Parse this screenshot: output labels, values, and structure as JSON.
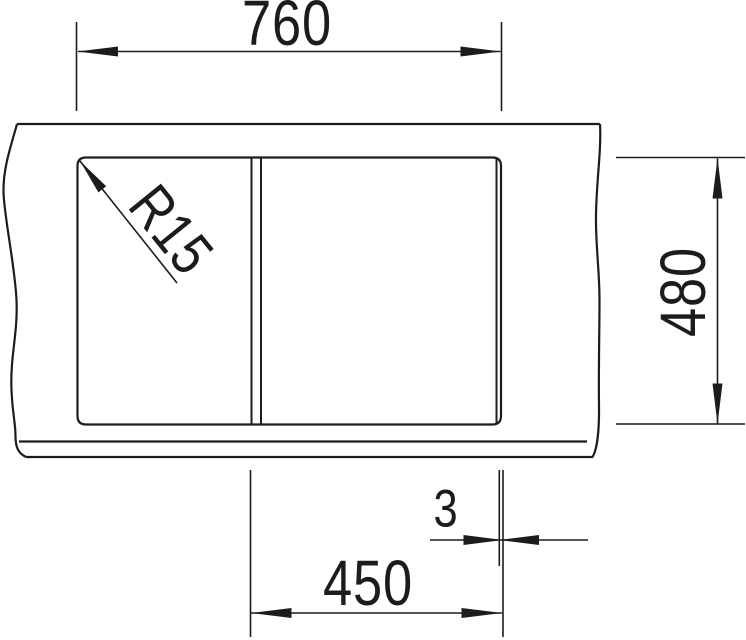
{
  "drawing": {
    "type": "technical-installation-drawing",
    "subject": "sink top view with countertop break lines, cutout outline, bowl divider and dimensions",
    "labels": {
      "overall_width": "760",
      "overall_depth": "480",
      "bowl_width": "450",
      "gap": "3",
      "corner_radius": "R15"
    },
    "units": "mm",
    "colors": {
      "line": "#1c1c1c",
      "background": "#ffffff"
    }
  }
}
